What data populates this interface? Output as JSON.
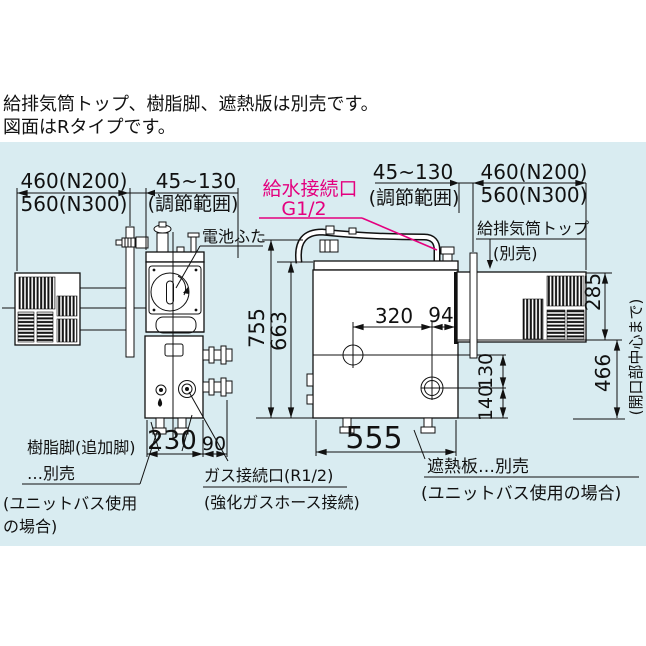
{
  "colors": {
    "panel_bg": "#d9ecf1",
    "ink": "#111111",
    "accent_pink": "#e4007f"
  },
  "note": {
    "line1": "給排気筒トップ、樹脂脚、遮熱版は別売です。",
    "line2": "図面はRタイプです。"
  },
  "side_view": {
    "dim_depth": {
      "n200": "460(N200)",
      "n300": "560(N300)"
    },
    "dim_adjust": {
      "value": "45~130",
      "sub": "(調節範囲)"
    },
    "battery_cover_label": "電池ふた",
    "dim_depth_bottom": "230",
    "dim_gas_offset": "90",
    "resin_leg_note": {
      "line1": "樹脂脚(追加脚)",
      "line2": "…別売",
      "line3": "(ユニットバス使用",
      "line4": "の場合)"
    },
    "gas_note": {
      "line1": "ガス接続口(R1/2)",
      "line2": "(強化ガスホース接続)"
    }
  },
  "front_view": {
    "water_label": {
      "line1": "給水接続口",
      "line2": "G1/2"
    },
    "dim_adjust": {
      "value": "45~130",
      "sub": "(調節範囲)"
    },
    "dim_depth": {
      "n200": "460(N200)",
      "n300": "560(N300)"
    },
    "flue_label": {
      "line1": "給排気筒トップ",
      "line2": "(別売)"
    },
    "dim_height_total": "755",
    "dim_height_body": "663",
    "dim_w_320": "320",
    "dim_w_94": "94",
    "dim_flue_285": "285",
    "dim_130": "130",
    "dim_140": "140",
    "dim_466": "466",
    "dim_466_sub": "(開口部中心まで)",
    "dim_width": "555",
    "shield_note": {
      "line1": "遮熱板…別売",
      "line2": "(ユニットバス使用の場合)"
    }
  }
}
